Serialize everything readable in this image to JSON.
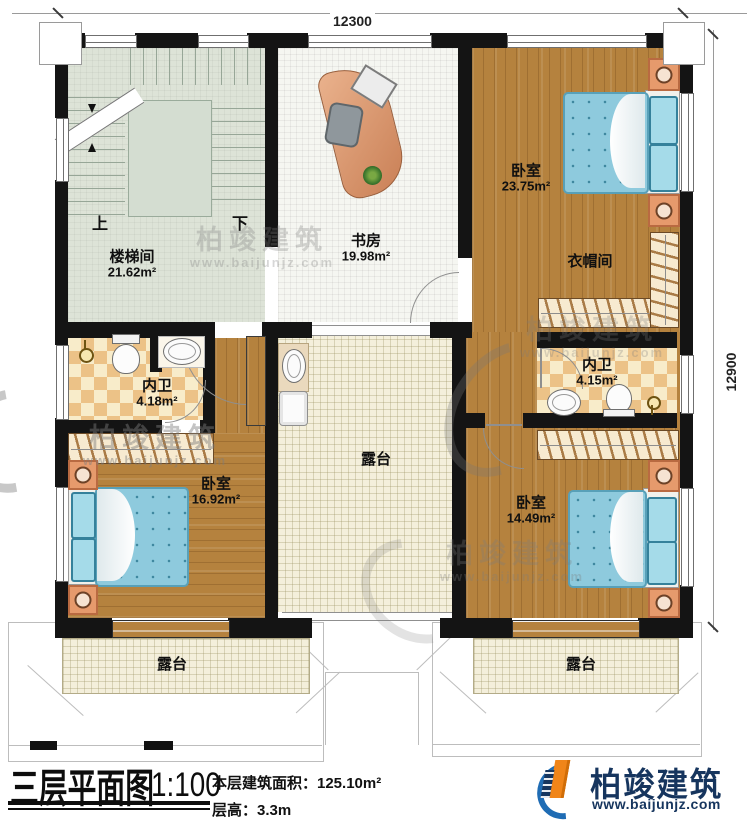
{
  "dimensions": {
    "top": "12300",
    "right": "12900"
  },
  "rooms": {
    "stairwell": {
      "label": "楼梯间",
      "area": "21.62m²"
    },
    "study": {
      "label": "书房",
      "area": "19.98m²"
    },
    "bedroom_ne": {
      "label": "卧室",
      "area": "23.75m²"
    },
    "cloakroom": {
      "label": "衣帽间"
    },
    "bath_east": {
      "label": "内卫",
      "area": "4.15m²"
    },
    "bath_west": {
      "label": "内卫",
      "area": "4.18m²"
    },
    "terrace_center": {
      "label": "露台"
    },
    "bedroom_sw": {
      "label": "卧室",
      "area": "16.92m²"
    },
    "bedroom_se": {
      "label": "卧室",
      "area": "14.49m²"
    },
    "terrace_sw": {
      "label": "露台"
    },
    "terrace_se": {
      "label": "露台"
    }
  },
  "stairs": {
    "up_label": "上",
    "down_label": "下"
  },
  "title_block": {
    "plan_title": "三层平面图",
    "scale": "1:100",
    "area_line": "本层建筑面积：125.10m²",
    "height_line": "层高：3.3m"
  },
  "brand": {
    "name": "柏竣建筑",
    "url": "www.baijunjz.com"
  },
  "colors": {
    "wall": "#141414",
    "wood_floor": "#b5823e",
    "bath_tile": "#ecc287",
    "terrace_floor": "#f4efdb",
    "stair_floor": "#dde3d7",
    "bed_blue": "#8ecadd",
    "accent_orange": "#f08519",
    "brand_navy": "#16355e",
    "swoosh_blue": "#1f6cb4"
  }
}
